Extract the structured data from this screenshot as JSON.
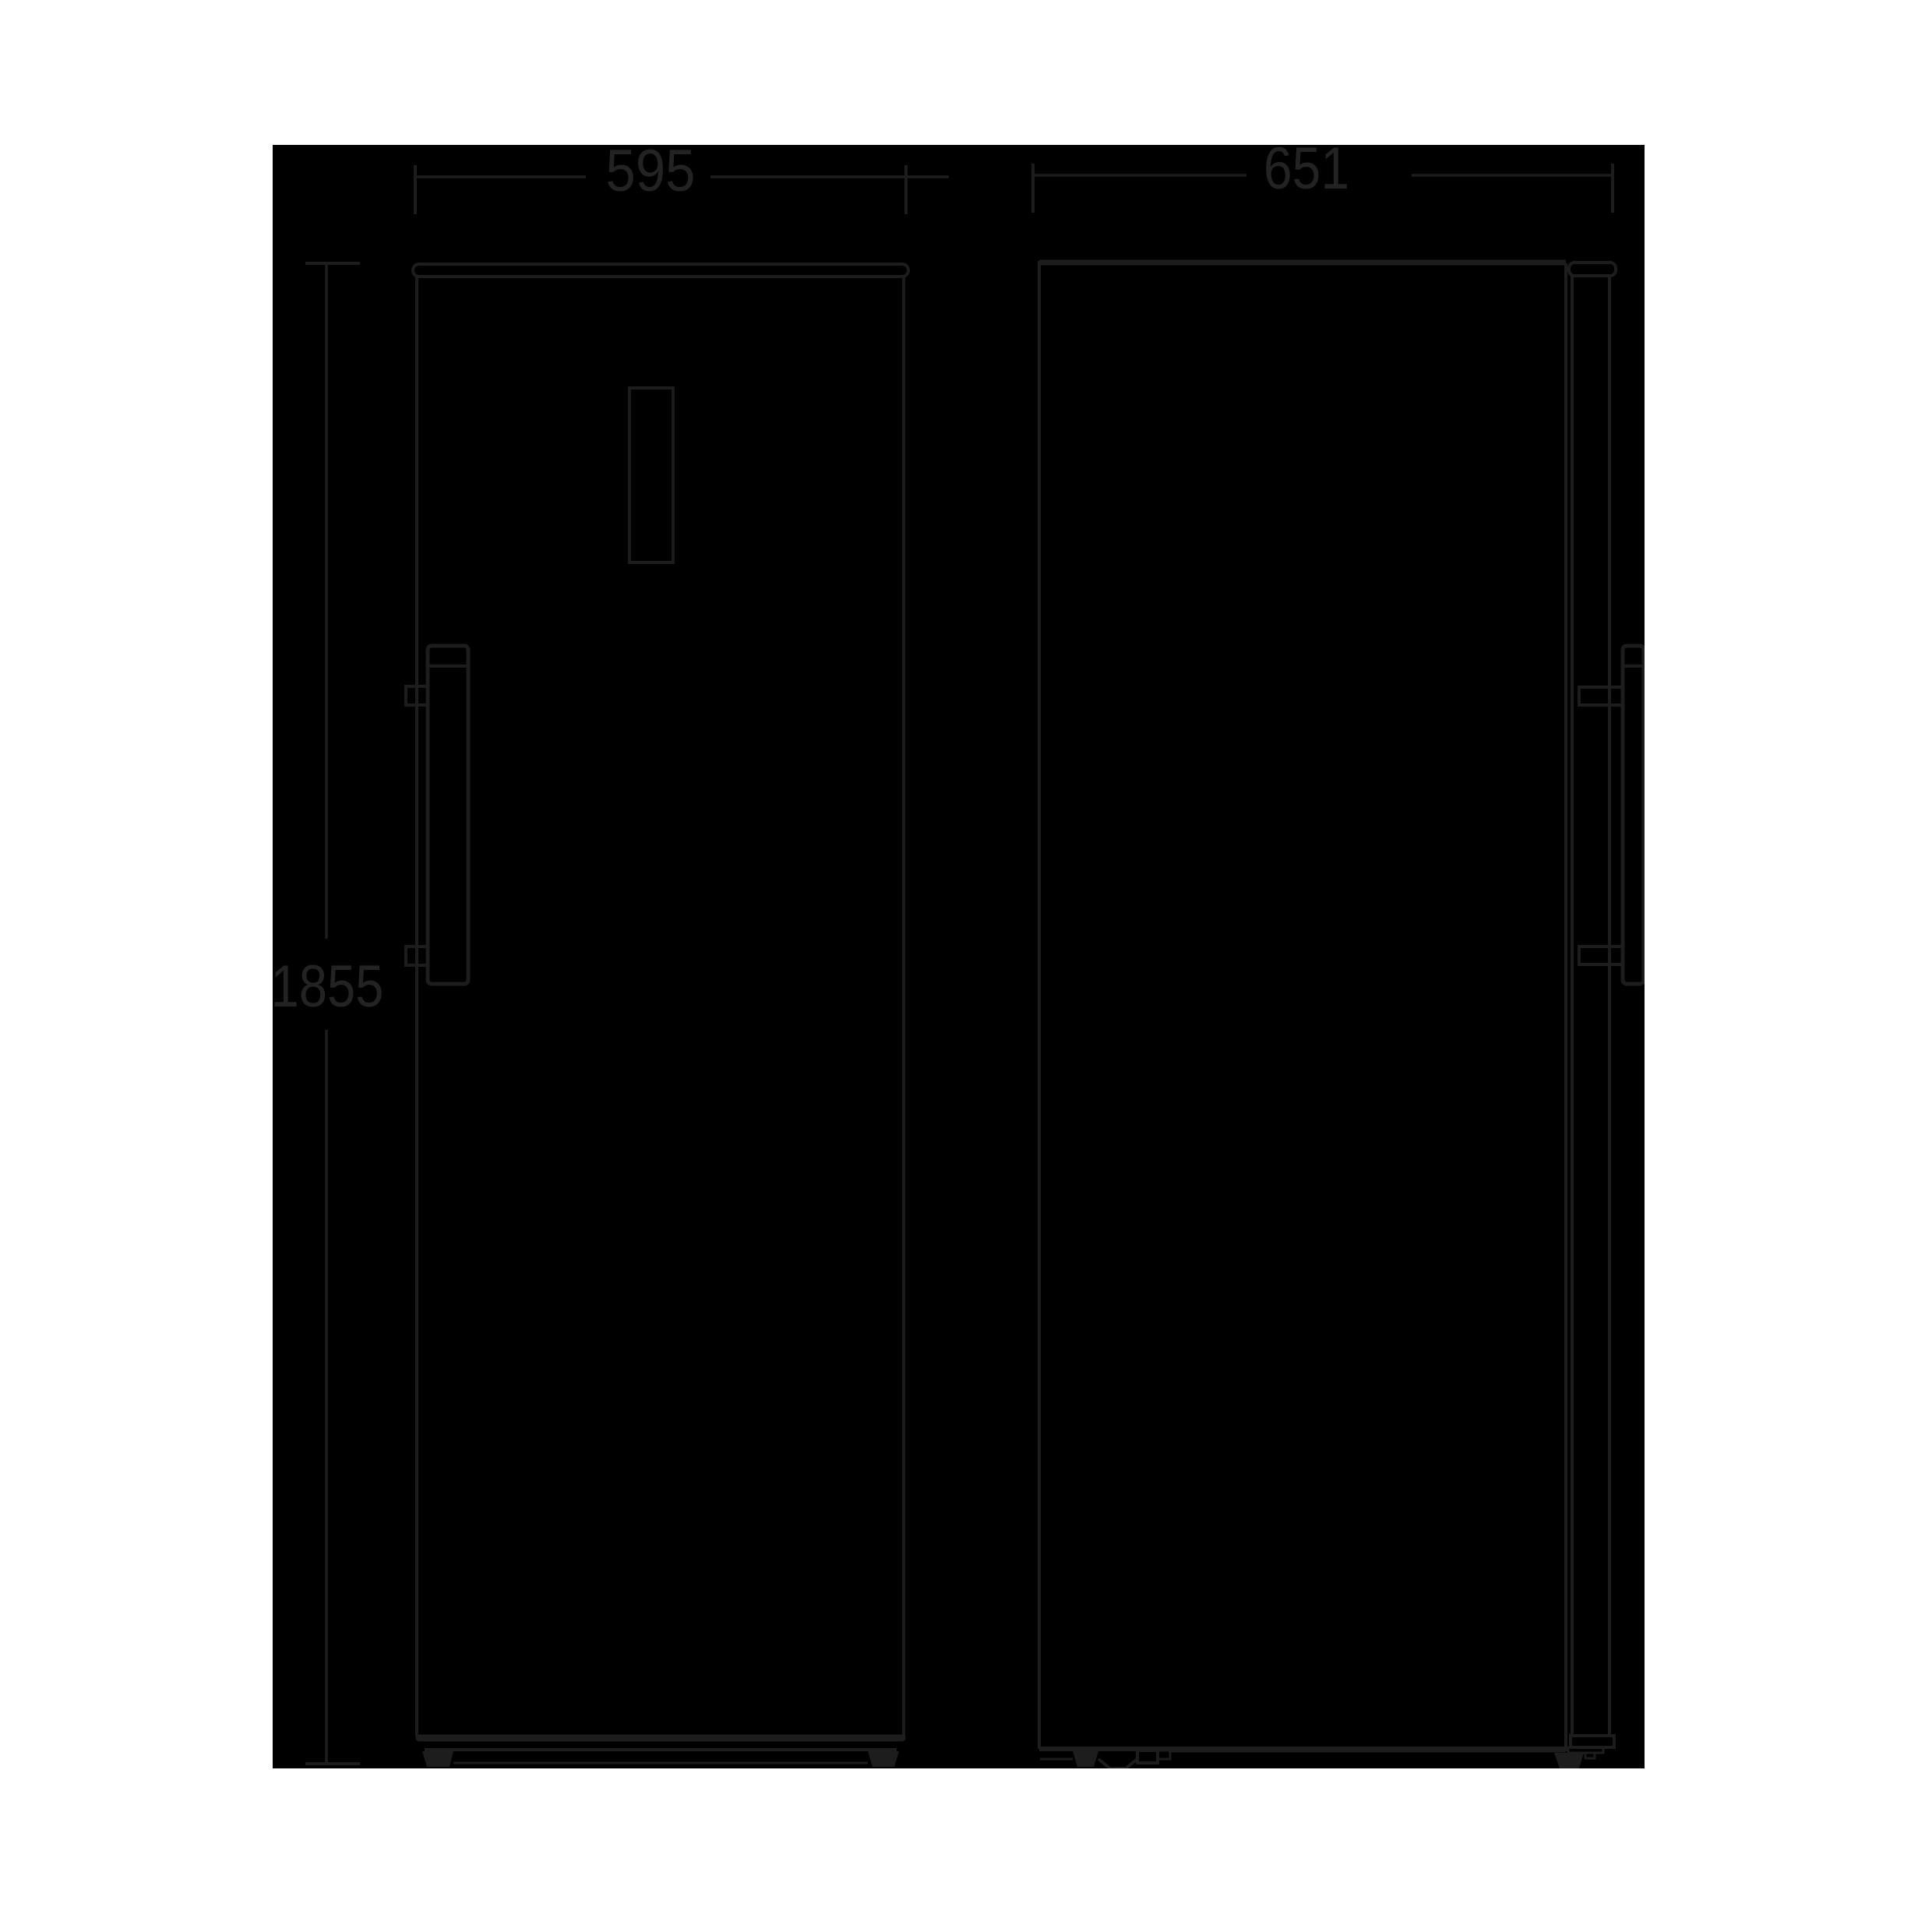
{
  "colors": {
    "page_background": "#ffffff",
    "panel_background": "#000000",
    "line": "#1d1d1d",
    "label_text": "#232323"
  },
  "dimensions": {
    "width": "595",
    "depth": "651",
    "height": "1855"
  }
}
